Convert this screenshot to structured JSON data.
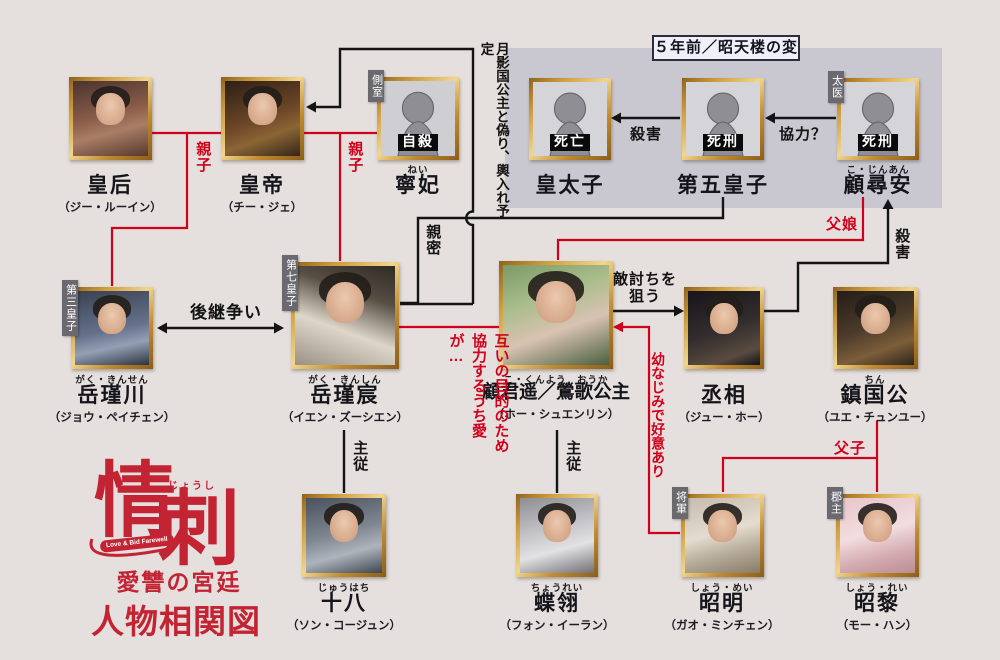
{
  "logo": {
    "furigana": "じょうし",
    "title_char1": "情",
    "title_char2": "刺",
    "subtitle_en": "Love & Bid Farewell",
    "subtitle": "愛讐の宮廷",
    "caption": "人物相関図"
  },
  "panel": {
    "title": "５年前／昭天楼の変"
  },
  "colors": {
    "background": "#e5dfdd",
    "panel_bg": "#c9c8d1",
    "accent_red": "#d0021b",
    "line_black": "#141414",
    "frame_gold": "#cf9d3e",
    "logo_red": "#c32433",
    "tag_gray": "#6a6970"
  },
  "persons": [
    {
      "name": "皇后",
      "actor": "（ジー・ルーイン）"
    },
    {
      "name": "皇帝",
      "actor": "（チー・ジェ）"
    },
    {
      "tag": "側室",
      "status": "自殺",
      "furigana": "ねい",
      "name": "寧妃"
    },
    {
      "status": "死亡",
      "name": "皇太子"
    },
    {
      "status": "死刑",
      "name": "第五皇子"
    },
    {
      "tag": "太医",
      "status": "死刑",
      "furigana": "こ・じんあん",
      "name": "顧尋安"
    },
    {
      "tag": "第三皇子",
      "furigana": "がく・きんせん",
      "name": "岳瑾川",
      "actor": "（ジョウ・ペイチェン）"
    },
    {
      "tag": "第七皇子",
      "furigana": "がく・きんしん",
      "name": "岳瑾宸",
      "actor": "（イエン・ズーシエン）"
    },
    {
      "furigana": "こ・くんよう　おうか",
      "name": "顧君遥／鶯歌公主",
      "actor": "（ホー・シュエンリン）"
    },
    {
      "name": "丞相",
      "actor": "（ジュー・ホー）"
    },
    {
      "furigana": "ちん",
      "name": "鎮国公",
      "actor": "（ユエ・チュンユー）"
    },
    {
      "furigana": "じゅうはち",
      "name": "十八",
      "actor": "（ソン・コージュン）"
    },
    {
      "furigana": "ちょうれい",
      "name": "蝶翎",
      "actor": "（フォン・イーラン）"
    },
    {
      "tag": "将軍",
      "furigana": "しょう・めい",
      "name": "昭明",
      "actor": "（ガオ・ミンチェン）"
    },
    {
      "tag": "郡主",
      "furigana": "しょう・れい",
      "name": "昭黎",
      "actor": "（モー・ハン）"
    }
  ],
  "labels": {
    "oyako_left": "親子",
    "oyako_right": "親子",
    "moon_note": "月影国公主と偽り、輿入れ予定",
    "shinmitsu": "親密",
    "succession": "後継争い",
    "satsugai_box": "殺害",
    "kyouryoku": "協力？",
    "chichimusume": "父娘",
    "satsugai_right": "殺害",
    "katakiuchi": "敵討ちを狙う",
    "cooperation_love": "互いの目的のため協力するうち愛が…",
    "osananajimi": "幼なじみで好意あり",
    "fushi": "父子",
    "shuju_left": "主従",
    "shuju_right": "主従"
  }
}
